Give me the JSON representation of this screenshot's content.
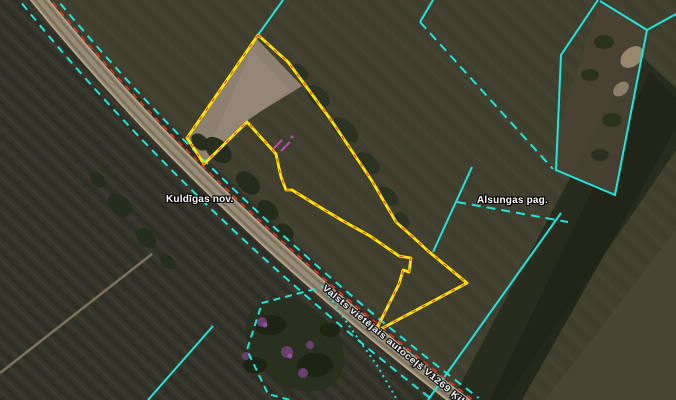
{
  "map": {
    "labels": {
      "municipality": "Kuldīgas nov.",
      "parish": "Alsungas pag.",
      "road": "Valsts vietējais autoceļš V1269 Ķikuri"
    },
    "legend": {
      "selected_parcel_color": "#ffe500",
      "cadastral_boundary_color": "#dd3420",
      "admin_boundary_color": "#1fe6dd",
      "road_color": "#998c74"
    }
  }
}
